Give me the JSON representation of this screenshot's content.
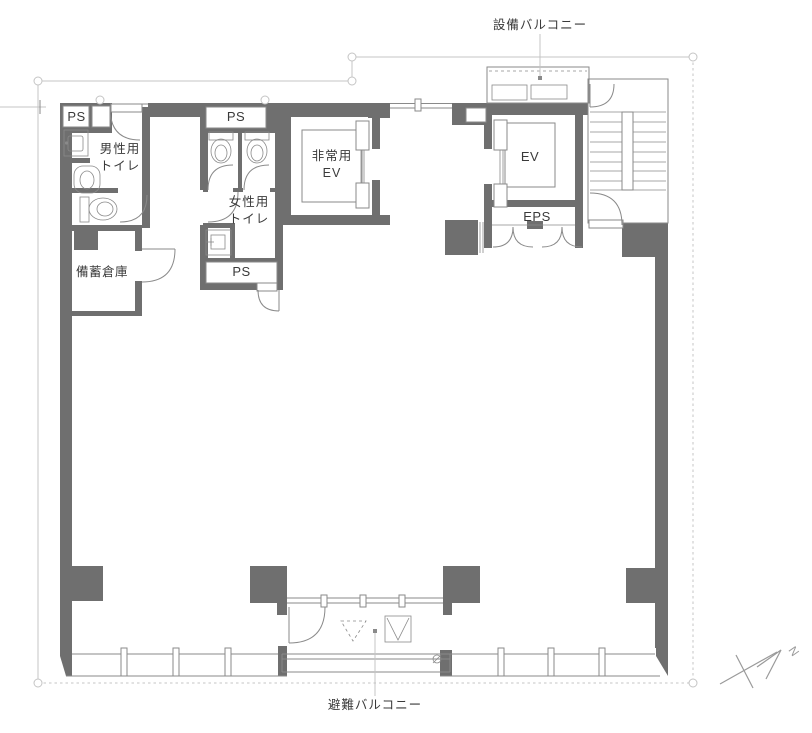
{
  "plan": {
    "labels": {
      "equipment_balcony": "設備バルコニー",
      "evacuation_balcony": "避難バルコニー",
      "mens_toilet": "男性用\nトイレ",
      "womens_toilet": "女性用\nトイレ",
      "storage": "備蓄倉庫",
      "emergency_elevator": "非常用\nEV",
      "elevator": "EV",
      "eps": "EPS",
      "ps_top_left": "PS",
      "ps_womens_top": "PS",
      "ps_womens_bottom": "PS",
      "north": "N"
    },
    "colors": {
      "wall": "#6f6f6f",
      "line": "#8a8a8a",
      "grid": "#c4c4c4",
      "text": "#3a3a3a",
      "bg": "#ffffff"
    }
  }
}
